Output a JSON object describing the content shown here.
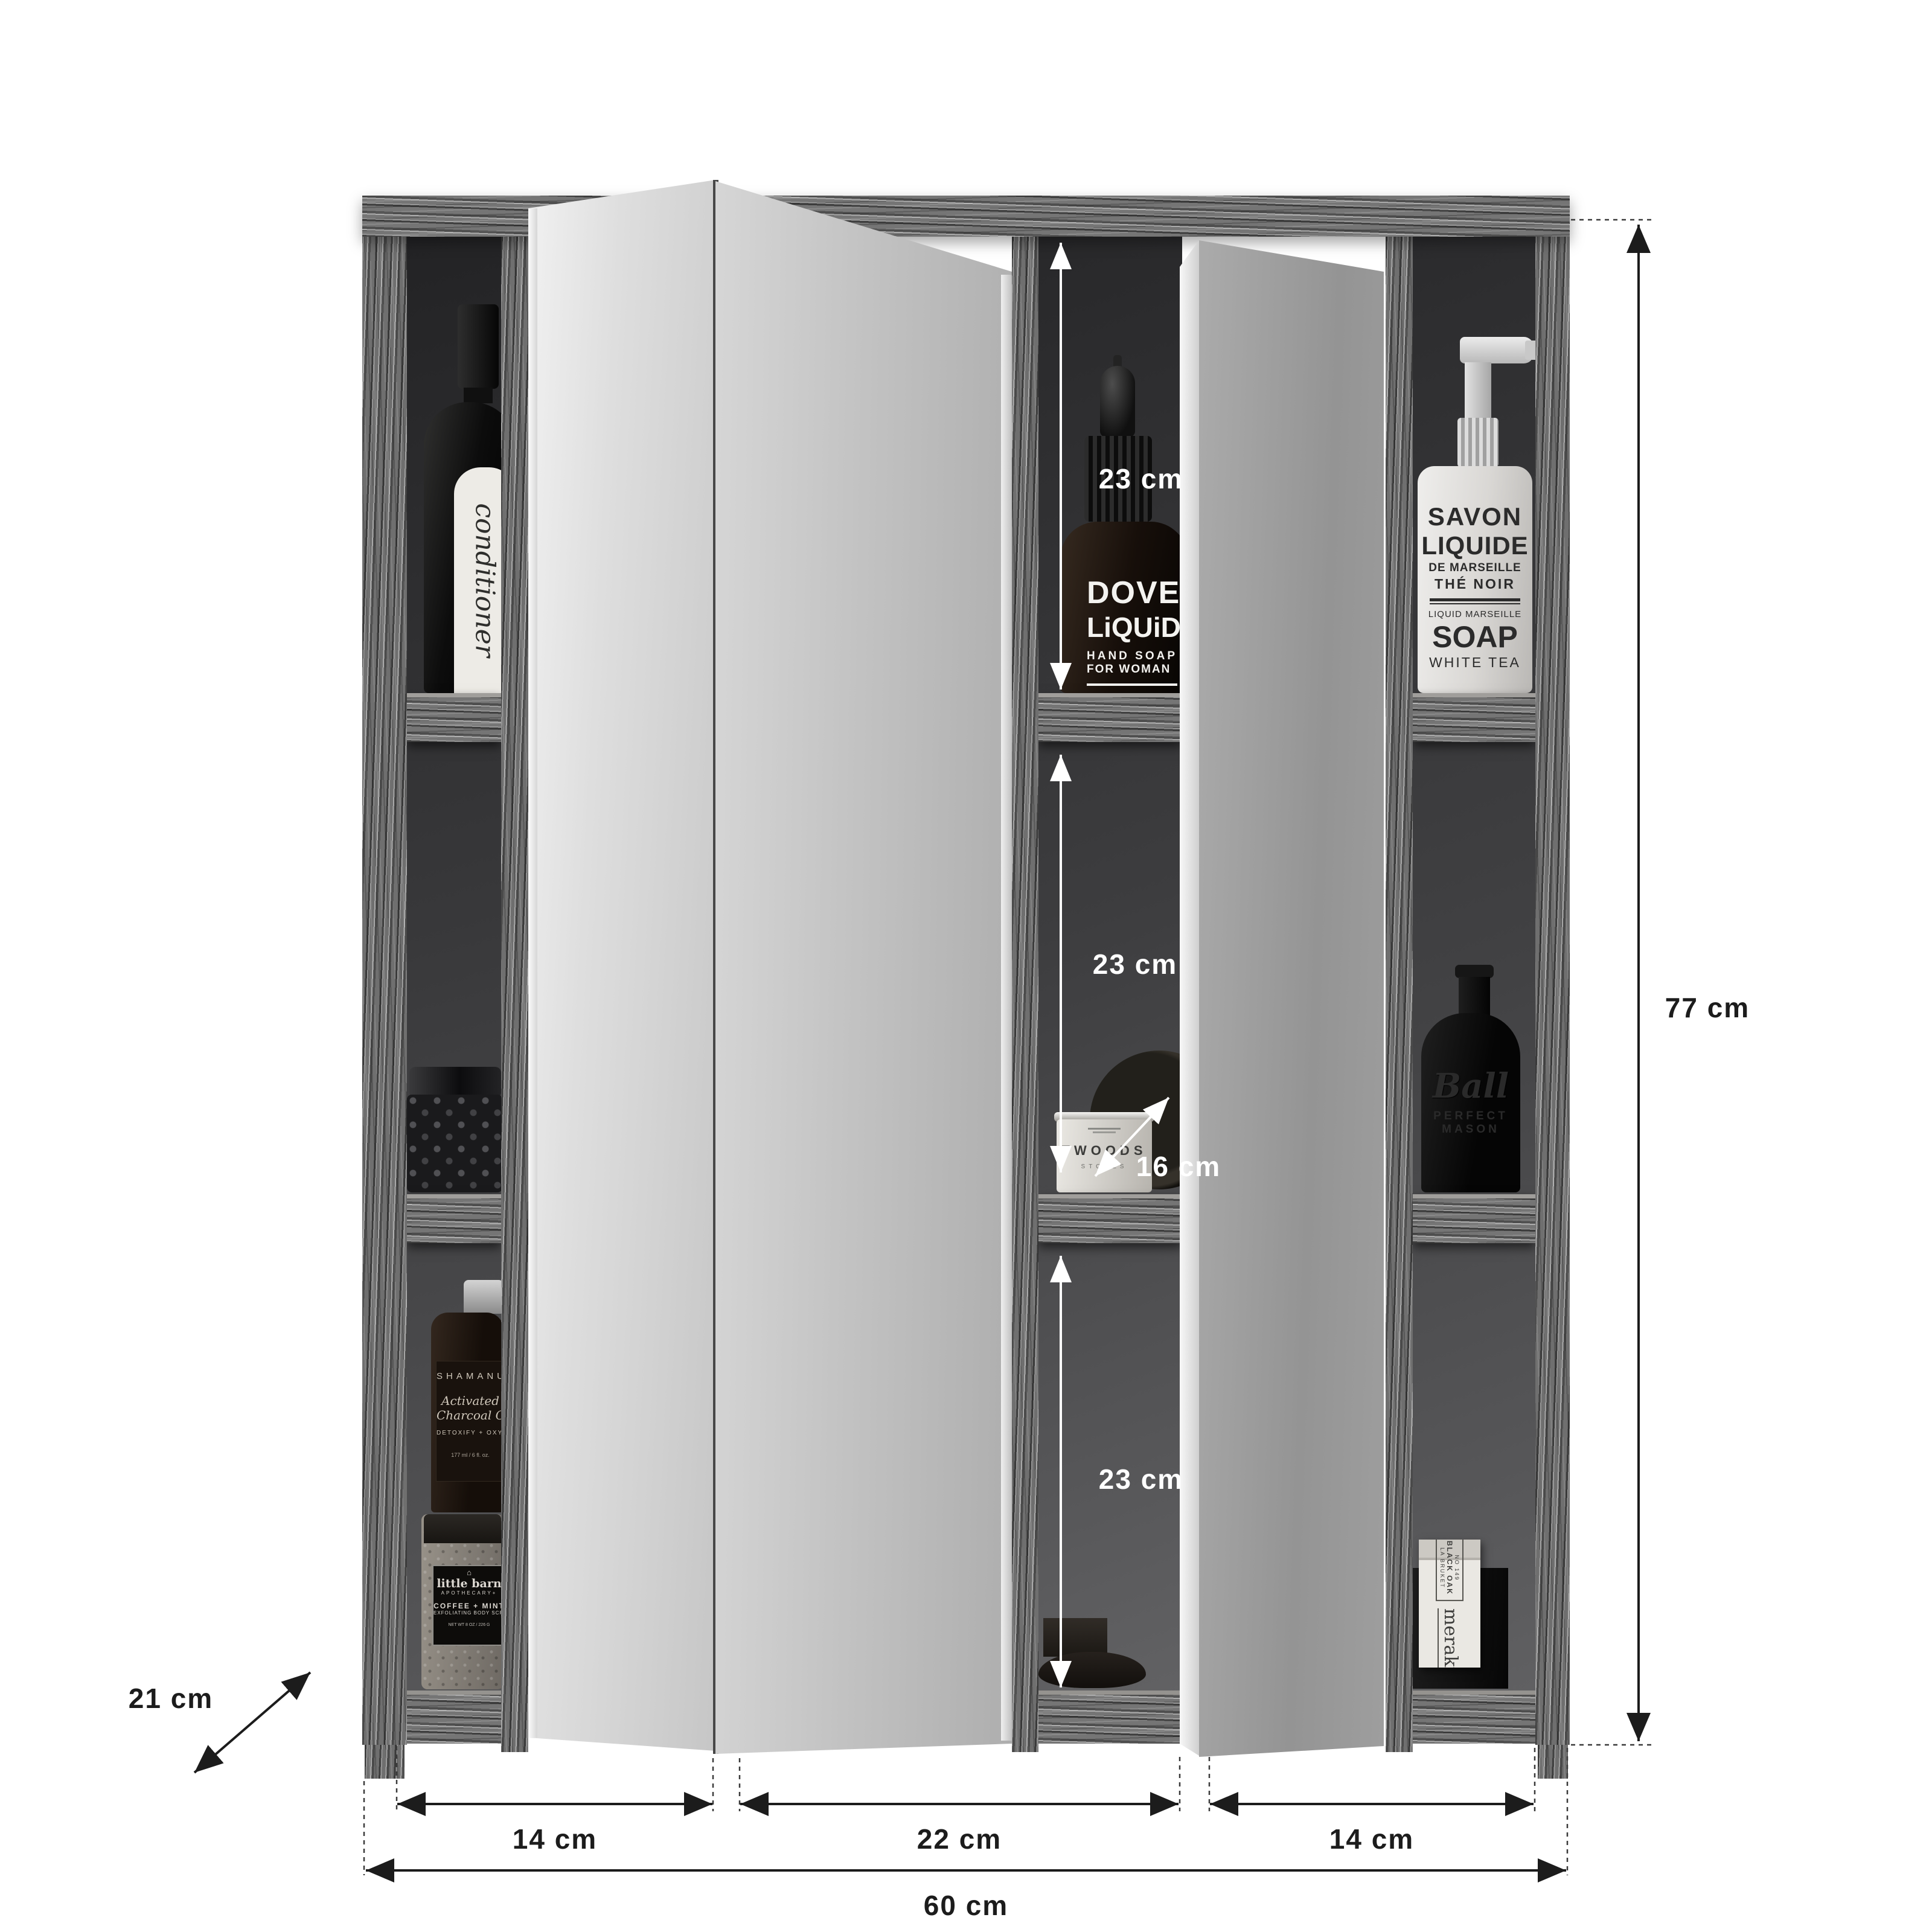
{
  "diagram": {
    "type": "furniture-dimension-diagram",
    "subject": "mirror wall cabinet with open shelves",
    "units": "cm",
    "labels": {
      "height": "77 cm",
      "width_total": "60 cm",
      "depth": "21 cm",
      "shelf_depth": "16 cm",
      "section_left": "14 cm",
      "section_middle": "22 cm",
      "section_right": "14 cm",
      "compartment_top": "23 cm",
      "compartment_middle": "23 cm",
      "compartment_bottom": "23 cm"
    }
  },
  "products": {
    "conditioner_bottle": {
      "label": "conditioner"
    },
    "dove_bottle": {
      "line1": "DOVE",
      "line2": "LiQUiD",
      "line3": "HAND SOAP",
      "line4": "FOR WOMAN",
      "line5": "BASED ON OL",
      "line6": "AND CAVA GR",
      "line7": "alc. vol % <3.7 because of"
    },
    "savon_bottle": {
      "line1": "SAVON",
      "line2": "LIQUIDE",
      "line3": "DE MARSEILLE",
      "line4": "THÉ NOIR",
      "line5": "LIQUID MARSEILLE",
      "line6": "SOAP",
      "line7": "WHITE TEA"
    },
    "shamanuti_bottle": {
      "line1": "SHAMANUTI",
      "line2": "Activated",
      "line3": "Charcoal Cleanser",
      "line4": "DETOXIFY + OXYGENATE",
      "line5": "177 ml / 6 fl. oz."
    },
    "littlebarn_jar": {
      "icon": "⌂",
      "line1": "little barn",
      "line2": "APOTHECARY+",
      "line3": "COFFEE + MINT",
      "line4": "EXFOLIATING BODY SCRUB",
      "line5": "NET WT 8 OZ / 226 G"
    },
    "twoods_jar": {
      "line1": "TWOODS",
      "line2": "STONES"
    },
    "ball_bottle": {
      "line1": "Ball",
      "line2": "PERFECT",
      "line3": "MASON"
    },
    "meraki_box": {
      "line1": "NO 149",
      "line2": "BLACK OAK",
      "line3": "LA BRUKET",
      "line4": "meraki"
    }
  },
  "colors": {
    "background": "#ffffff",
    "dimension_text_dark": "#1c1c1c",
    "dimension_text_light": "#ffffff",
    "wood_base": "#717171",
    "interior_dark": "#29292b",
    "mirror_light": "#d9d9d9"
  }
}
